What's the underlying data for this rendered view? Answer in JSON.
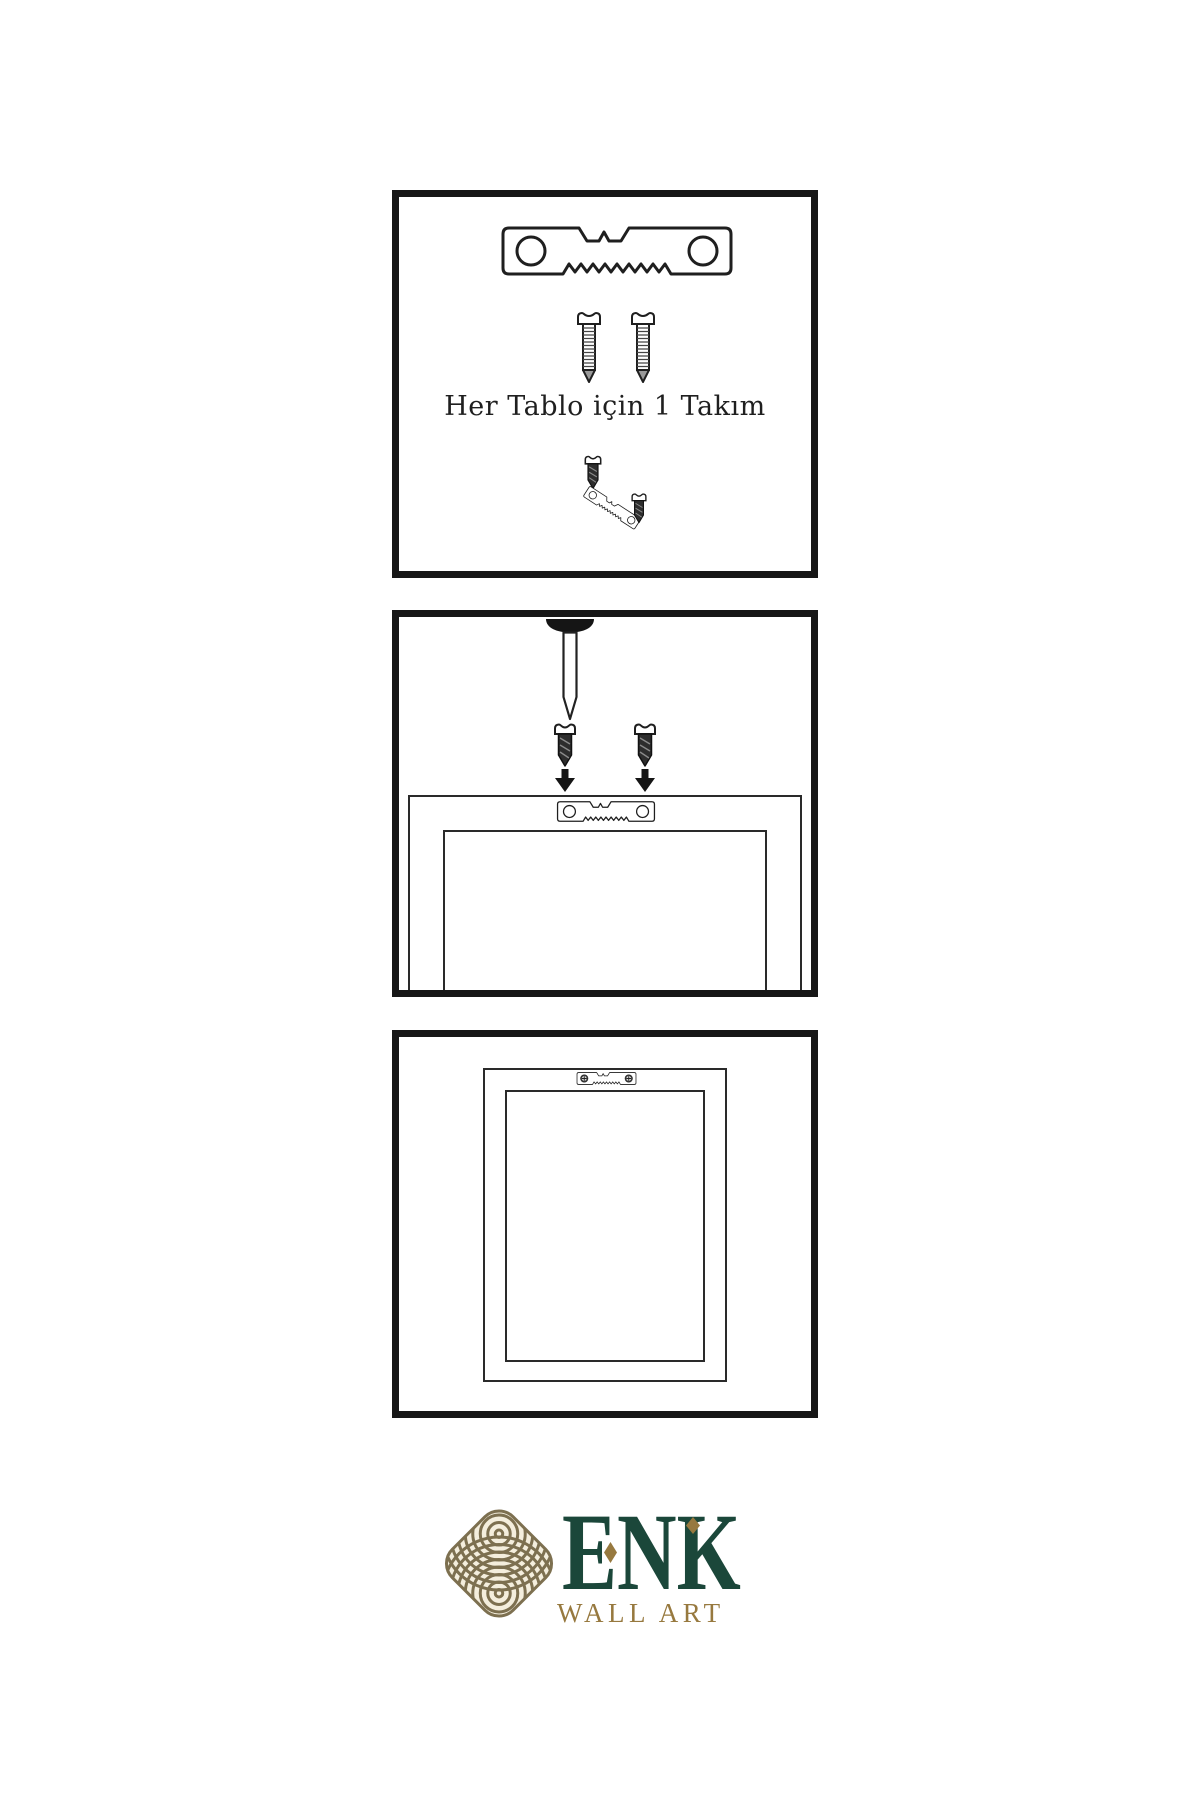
{
  "panel1": {
    "caption": "Her Tablo için 1 Takım",
    "icons": [
      "sawtooth-hanger",
      "mounting-screw",
      "mounting-screw",
      "dark-screw",
      "tilted-sawtooth-hanger",
      "dark-screw"
    ]
  },
  "panel2": {
    "icons": [
      "wall-nail",
      "dark-screw",
      "dark-screw",
      "down-arrow",
      "down-arrow",
      "frame-back-outline",
      "sawtooth-hanger"
    ]
  },
  "panel3": {
    "icons": [
      "frame-back-outline",
      "sawtooth-hanger-installed"
    ]
  },
  "logo": {
    "brand": "ENK",
    "subtitle": "WALL ART",
    "knot_icon": "interlaced-knot",
    "colors": {
      "brand_green": "#1b473a",
      "gold": "#97793f",
      "knot_line": "#7d7050",
      "knot_fill": "#f4eedd"
    }
  },
  "colors": {
    "background": "#ffffff",
    "panel_border": "#171717",
    "line_art": "#2a2a2a"
  }
}
